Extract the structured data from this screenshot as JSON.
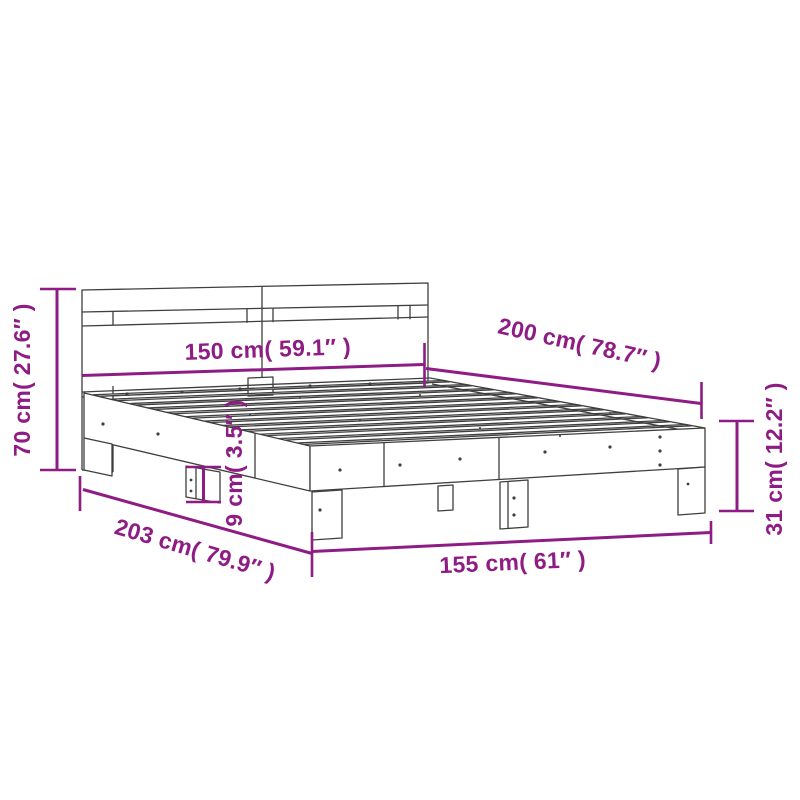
{
  "page": {
    "background": "#ffffff"
  },
  "diagram": {
    "title": "Bed frame dimension diagram",
    "accent_color": "#8E1C84",
    "line_color": "#3f3f3f",
    "dimensions": [
      {
        "id": "headboard-width",
        "cm": 150,
        "inches": 59.1,
        "label": "150 cm( 59.1″ )"
      },
      {
        "id": "bed-length-top",
        "cm": 200,
        "inches": 78.7,
        "label": "200 cm( 78.7″ )"
      },
      {
        "id": "headboard-height",
        "cm": 70,
        "inches": 27.6,
        "label": "70 cm( 27.6″ )"
      },
      {
        "id": "base-length",
        "cm": 203,
        "inches": 79.9,
        "label": "203 cm( 79.9″ )"
      },
      {
        "id": "base-width",
        "cm": 155,
        "inches": 61,
        "label": "155 cm( 61″ )"
      },
      {
        "id": "foot-height",
        "cm": 31,
        "inches": 12.2,
        "label": "31 cm( 12.2″ )"
      },
      {
        "id": "rail-height",
        "cm": 9,
        "inches": 3.5,
        "label": "9 cm( 3.5″ )"
      }
    ]
  }
}
